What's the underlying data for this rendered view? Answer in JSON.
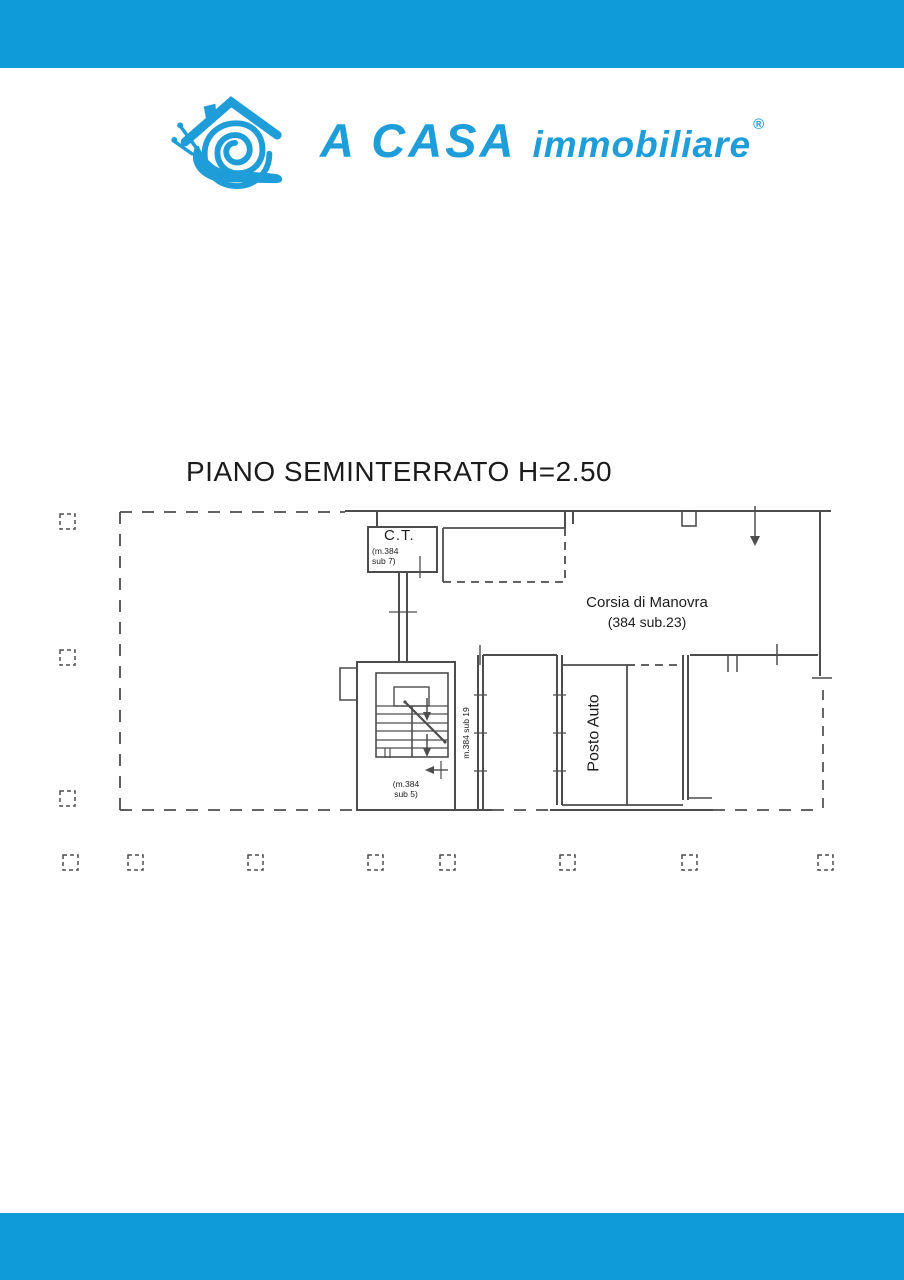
{
  "page": {
    "top_bar_color": "#0f9bda",
    "bottom_bar_color": "#0f9bda",
    "background_color": "#ffffff",
    "plan_line_color": "#4d4d4d"
  },
  "logo": {
    "icon": "snail-house-icon",
    "brand": "A CASA",
    "brand_suffix": "immobiliare",
    "registered": "®",
    "color": "#1f9dd9"
  },
  "floorplan": {
    "title": "PIANO SEMINTERRATO H=2.50",
    "labels": {
      "ct": "C.T.",
      "ct_sub_line1": "(m.384",
      "ct_sub_line2": "sub 7)",
      "corsia_line1": "Corsia di Manovra",
      "corsia_line2": "(384 sub.23)",
      "posto_auto": "Posto Auto",
      "corridor": "m.384 sub 19",
      "stair_sub_line1": "(m.384",
      "stair_sub_line2": "sub 5)"
    }
  }
}
